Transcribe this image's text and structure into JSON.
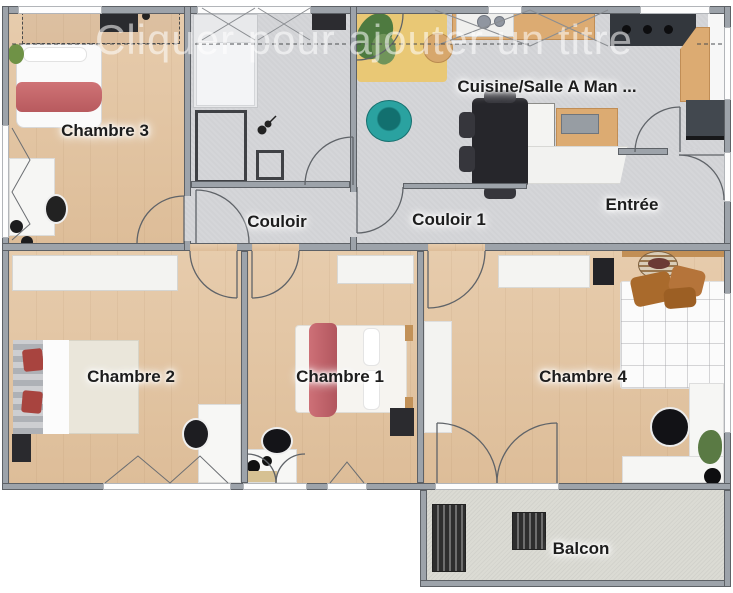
{
  "title_watermark": "Cliquer pour ajouter un titre",
  "rooms": {
    "chambre3": {
      "label": "Chambre 3"
    },
    "couloir": {
      "label": "Couloir"
    },
    "couloir1": {
      "label": "Couloir 1"
    },
    "cuisine": {
      "label": "Cuisine/Salle A Man ..."
    },
    "entree": {
      "label": "Entrée"
    },
    "chambre2": {
      "label": "Chambre 2"
    },
    "chambre1": {
      "label": "Chambre 1"
    },
    "chambre4": {
      "label": "Chambre 4"
    },
    "balcon": {
      "label": "Balcon"
    }
  },
  "colors": {
    "wood_floor": "#e4c6a3",
    "hard_floor": "#d5d6d9",
    "balcony_floor": "#dbdbd4",
    "wall": "#9da3aa",
    "accent_red_blanket": "#c2646a",
    "accent_teal_chair": "#2aa2a0",
    "accent_orange_pillow": "#a96a2c",
    "counter_wood": "#dcab72"
  }
}
